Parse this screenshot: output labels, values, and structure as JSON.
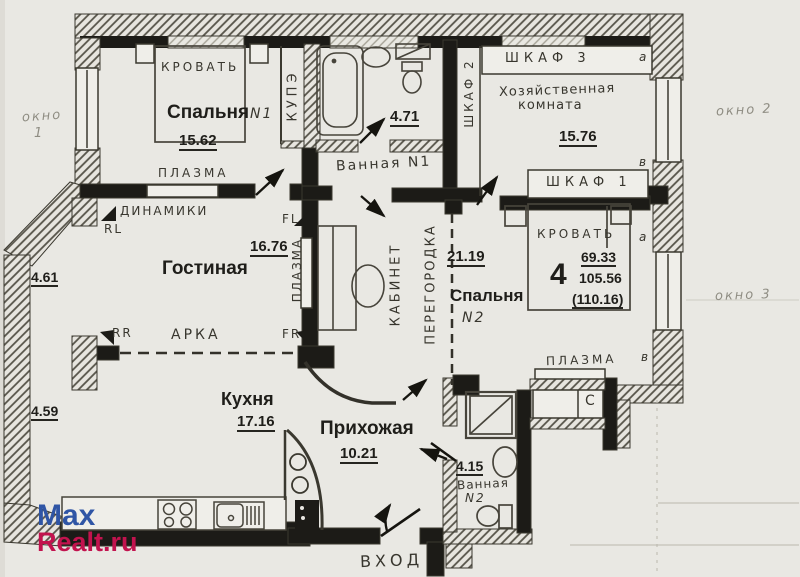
{
  "plan": {
    "bedroom1": {
      "name": "Спальня",
      "number": "N1",
      "area": "15.62",
      "bed_label": "КРОВАТЬ",
      "tv_label": "ПЛАЗМА"
    },
    "closet_kupe": {
      "label": "КУПЭ"
    },
    "bathroom1": {
      "label": "Ванная N1",
      "area": "4.71"
    },
    "wardrobes": {
      "w1": "ШКАФ 1",
      "w2": "ШКАФ 2",
      "w3": "ШКАФ 3"
    },
    "utility": {
      "name_line1": "Хозяйственная",
      "name_line2": "комната",
      "area": "15.76"
    },
    "living": {
      "name": "Гостиная",
      "area": "16.76",
      "speakers_label": "ДИНАМИКИ",
      "arch_label": "АРКА",
      "tv_label": "ПЛАЗМА",
      "spk": {
        "rl": "RL",
        "fl": "FL",
        "rr": "RR",
        "fr": "FR"
      }
    },
    "office": {
      "label": "КАБИНЕТ"
    },
    "partition": {
      "label": "ПЕРЕГОРОДКА",
      "corridor_area": "21.19"
    },
    "bedroom2": {
      "name": "Спальня",
      "number": "N2",
      "bed_label": "КРОВАТЬ",
      "tv_label": "ПЛАЗМА",
      "flat_number": "4",
      "areas": {
        "living": "69.33",
        "total": "105.56",
        "full": "(110.16)"
      }
    },
    "kitchen": {
      "name": "Кухня",
      "area": "17.16"
    },
    "hallway": {
      "name": "Прихожая",
      "area": "10.21"
    },
    "bathroom2": {
      "area": "4.15",
      "name_line1": "Ванная",
      "name_line2": "N2"
    },
    "entrance": {
      "label": "ВХОД"
    },
    "wall_dimensions": {
      "upper": "4.61",
      "lower": "4.59"
    },
    "window_labels": {
      "w1_line1": "окно",
      "w1_line2": "1",
      "w2": "окно 2",
      "w3": "окно 3"
    },
    "axis_marks": {
      "m1": "а",
      "m2": "в",
      "m3": "а",
      "m4": "в"
    },
    "shaft_label": "С"
  },
  "watermark": {
    "line1": "Max",
    "line2": "Realt.ru",
    "color_line1": "#2f55a5",
    "color_line2": "#c2134e"
  }
}
